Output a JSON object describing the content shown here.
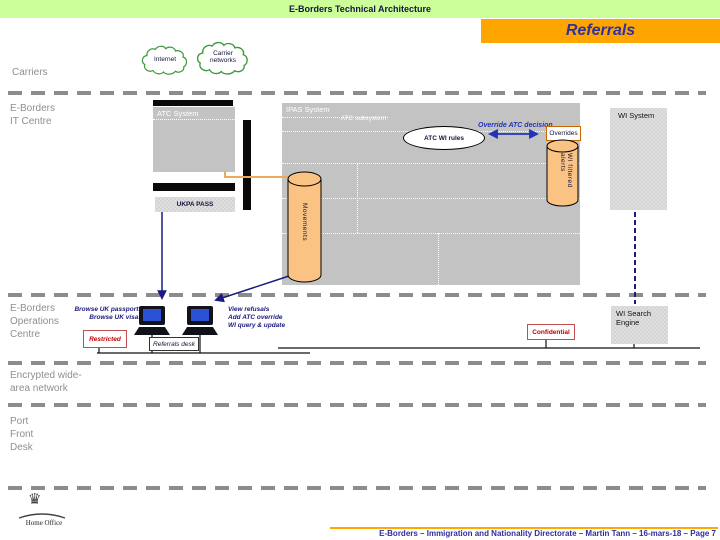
{
  "header": {
    "title": "E-Borders Technical Architecture",
    "banner": "Referrals"
  },
  "clouds": {
    "internet": "Internet",
    "carrier_line1": "Carrier",
    "carrier_line2": "networks"
  },
  "lanes": {
    "carriers": "Carriers",
    "it_centre_1": "E-Borders",
    "it_centre_2": "IT Centre",
    "ops_1": "E-Borders",
    "ops_2": "Operations",
    "ops_3": "Centre",
    "wan_1": "Encrypted wide-",
    "wan_2": "area network",
    "port_1": "Port",
    "port_2": "Front",
    "port_3": "Desk"
  },
  "it_centre": {
    "atc_system": "ATC System",
    "ipas_system": "IPAS System",
    "atc_subsystem": "ATC subsystem",
    "atc_wi_rules": "ATC WI rules",
    "override_label": "Override ATC decision",
    "overrides_box": "Overrides",
    "wi_filtered_cylinder": "WI filtered alerts",
    "movements_cylinder": "Movements",
    "ukpa_pass": "UKPA PASS",
    "wi_system": "WI System"
  },
  "ops_centre": {
    "monitor_left_notes": [
      "Browse UK passports",
      "Browse UK visas"
    ],
    "monitor_right_notes": [
      "View refusals",
      "Add ATC override",
      "WI query & update"
    ],
    "restricted": "Restricted",
    "referrals_desk": "Referrals desk",
    "confidential": "Confidential",
    "wi_search_engine_1": "WI Search",
    "wi_search_engine_2": "Engine"
  },
  "footer": {
    "logo_text": "Home Office",
    "credit": "E-Borders – Immigration and Nationality Directorate – Martin Tann – 16-mars-18 – Page 7"
  },
  "colors": {
    "header_green": "#ccff99",
    "banner_orange": "#ffa500",
    "box_gray": "#c3c3c3",
    "cylinder_tan": "#fbc383",
    "navy": "#1a1a80",
    "classification_red": "#c00000"
  }
}
